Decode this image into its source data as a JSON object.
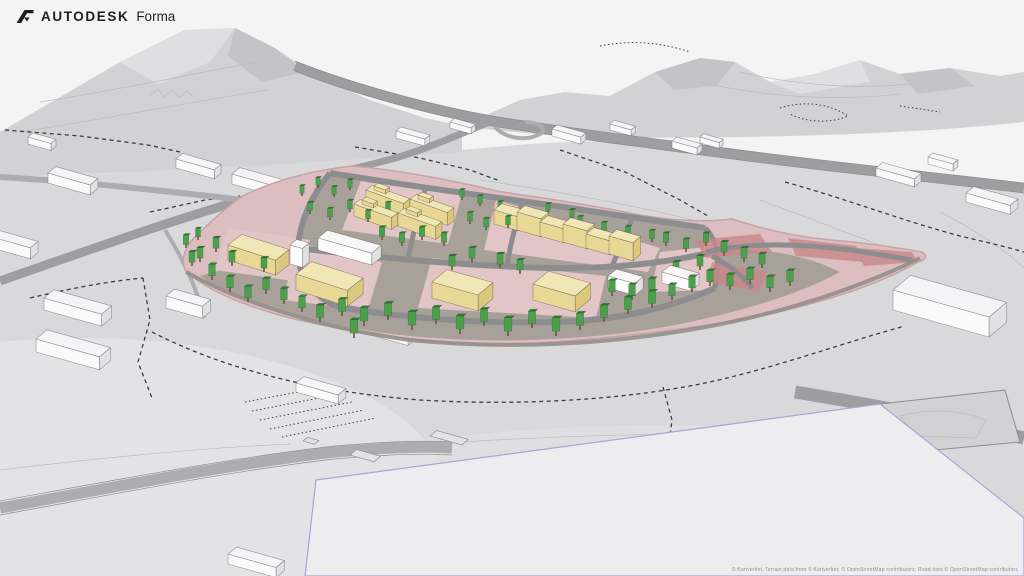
{
  "header": {
    "brand_primary": "AUTODESK",
    "brand_product": "Forma"
  },
  "footer": {
    "attribution": "© Kartverket, Terrain data from © Kartverket, © OpenStreetMap contributors, Road data © OpenStreetMap contributors"
  },
  "colors": {
    "sky": "#f4f4f5",
    "mountain": "#d2d2d5",
    "mountainDark": "#c4c4c8",
    "mountainLight": "#dfdfe1",
    "terrain": "#d9d9db",
    "terrainLight": "#e3e3e5",
    "contour": "#bcbcbf",
    "dash": "#3c3c3c",
    "roadMajor": "#9e9ea0",
    "roadMinor": "#adadaf",
    "roadEdge": "#8c8c8e",
    "sitePink": "#dcbec0",
    "sitePlot": "#e1c5c7",
    "siteEdge": "#c5a3a6",
    "siteGray": "#a8a19a",
    "siteRoad": "#8d8d8f",
    "redRoad": "#c78787",
    "perimeter": "#948e88",
    "planeFill": "#ededef",
    "planeEdge": "#b3a0d4",
    "yellowFront": "#e9d795",
    "yellowSide": "#dcc77f",
    "yellowRoof": "#f1e7b6",
    "whiteFront": "#fcfcfd",
    "whiteSide": "#e2e2e5",
    "whiteRoof": "#f7f7f9",
    "ctxFront": "#fafafb",
    "ctxSide": "#e1e1e4",
    "ctxRoof": "#f4f4f6",
    "treeBody": "#4aa04b",
    "treeTop": "#2f7d33",
    "treeTrunk": "#7a5044"
  },
  "scene": {
    "proposal_buildings": [
      {
        "x": 354,
        "y": 216,
        "w": 40,
        "d": 11,
        "h": 12,
        "r": 4,
        "c": "yellow"
      },
      {
        "x": 366,
        "y": 202,
        "w": 40,
        "d": 11,
        "h": 12,
        "r": 4,
        "c": "yellow"
      },
      {
        "x": 398,
        "y": 226,
        "w": 40,
        "d": 11,
        "h": 13,
        "r": 4,
        "c": "yellow"
      },
      {
        "x": 410,
        "y": 212,
        "w": 40,
        "d": 11,
        "h": 13,
        "r": 4,
        "c": "yellow"
      },
      {
        "x": 362,
        "y": 204,
        "w": 12,
        "d": 7,
        "h": 4,
        "r": 4,
        "c": "yellow",
        "z": 217
      },
      {
        "x": 374,
        "y": 190,
        "w": 12,
        "d": 7,
        "h": 4,
        "r": 4,
        "c": "yellow",
        "z": 203
      },
      {
        "x": 406,
        "y": 213,
        "w": 12,
        "d": 7,
        "h": 4,
        "r": 4,
        "c": "yellow",
        "z": 227
      },
      {
        "x": 418,
        "y": 199,
        "w": 12,
        "d": 7,
        "h": 4,
        "r": 4,
        "c": "yellow",
        "z": 213
      },
      {
        "x": 494,
        "y": 224,
        "w": 25,
        "d": 14,
        "h": 14,
        "c": "yellow"
      },
      {
        "x": 517,
        "y": 230,
        "w": 25,
        "d": 14,
        "h": 18,
        "c": "yellow"
      },
      {
        "x": 540,
        "y": 236,
        "w": 25,
        "d": 14,
        "h": 14,
        "c": "yellow"
      },
      {
        "x": 563,
        "y": 242,
        "w": 25,
        "d": 14,
        "h": 18,
        "c": "yellow"
      },
      {
        "x": 586,
        "y": 248,
        "w": 25,
        "d": 14,
        "h": 14,
        "c": "yellow"
      },
      {
        "x": 609,
        "y": 254,
        "w": 25,
        "d": 14,
        "h": 18,
        "c": "yellow"
      },
      {
        "x": 228,
        "y": 260,
        "w": 50,
        "d": 24,
        "h": 15,
        "r": 2,
        "c": "yellow"
      },
      {
        "x": 296,
        "y": 290,
        "w": 54,
        "d": 28,
        "h": 16,
        "r": 2,
        "c": "yellow"
      },
      {
        "x": 432,
        "y": 298,
        "w": 48,
        "d": 27,
        "h": 16,
        "c": "yellow"
      },
      {
        "x": 533,
        "y": 300,
        "w": 44,
        "d": 28,
        "h": 16,
        "c": "yellow"
      },
      {
        "x": 290,
        "y": 264,
        "w": 13,
        "d": 12,
        "h": 19,
        "c": "white"
      },
      {
        "x": 318,
        "y": 250,
        "w": 56,
        "d": 17,
        "h": 12,
        "c": "white"
      },
      {
        "x": 608,
        "y": 288,
        "w": 28,
        "d": 15,
        "h": 12,
        "c": "white"
      },
      {
        "x": 662,
        "y": 283,
        "w": 30,
        "d": 15,
        "h": 11,
        "c": "white"
      }
    ],
    "context_buildings": [
      {
        "x": 28,
        "y": 144,
        "w": 24,
        "d": 9,
        "h": 7
      },
      {
        "x": 48,
        "y": 183,
        "w": 44,
        "d": 14,
        "h": 10
      },
      {
        "x": -8,
        "y": 248,
        "w": 40,
        "d": 14,
        "h": 11
      },
      {
        "x": 44,
        "y": 310,
        "w": 60,
        "d": 18,
        "h": 12
      },
      {
        "x": 36,
        "y": 352,
        "w": 66,
        "d": 20,
        "h": 13
      },
      {
        "x": 166,
        "y": 308,
        "w": 38,
        "d": 15,
        "h": 12
      },
      {
        "x": 176,
        "y": 168,
        "w": 40,
        "d": 12,
        "h": 9
      },
      {
        "x": 232,
        "y": 184,
        "w": 48,
        "d": 14,
        "h": 10
      },
      {
        "x": 360,
        "y": 332,
        "w": 50,
        "d": 18,
        "h": 11
      },
      {
        "x": 296,
        "y": 392,
        "w": 44,
        "d": 14,
        "h": 9
      },
      {
        "x": 396,
        "y": 138,
        "w": 30,
        "d": 9,
        "h": 7
      },
      {
        "x": 450,
        "y": 128,
        "w": 22,
        "d": 8,
        "h": 6
      },
      {
        "x": 552,
        "y": 136,
        "w": 30,
        "d": 9,
        "h": 7
      },
      {
        "x": 610,
        "y": 130,
        "w": 22,
        "d": 8,
        "h": 6
      },
      {
        "x": 672,
        "y": 148,
        "w": 26,
        "d": 9,
        "h": 7
      },
      {
        "x": 700,
        "y": 143,
        "w": 20,
        "d": 7,
        "h": 6
      },
      {
        "x": 876,
        "y": 176,
        "w": 40,
        "d": 12,
        "h": 8
      },
      {
        "x": 928,
        "y": 164,
        "w": 26,
        "d": 9,
        "h": 7
      },
      {
        "x": 966,
        "y": 202,
        "w": 46,
        "d": 14,
        "h": 9
      },
      {
        "x": 893,
        "y": 310,
        "w": 100,
        "d": 32,
        "h": 20
      },
      {
        "x": 228,
        "y": 564,
        "w": 50,
        "d": 15,
        "h": 10
      }
    ],
    "footprints": [
      {
        "x": 303,
        "y": 441,
        "w": 12,
        "d": 8
      },
      {
        "x": 350,
        "y": 455,
        "w": 25,
        "d": 12
      },
      {
        "x": 430,
        "y": 436,
        "w": 33,
        "d": 12
      }
    ],
    "trees": [
      [
        302,
        196,
        8
      ],
      [
        318,
        188,
        8
      ],
      [
        334,
        197,
        8
      ],
      [
        350,
        190,
        8
      ],
      [
        310,
        214,
        9
      ],
      [
        330,
        220,
        9
      ],
      [
        350,
        212,
        9
      ],
      [
        368,
        222,
        9
      ],
      [
        388,
        214,
        9
      ],
      [
        462,
        200,
        8
      ],
      [
        480,
        206,
        8
      ],
      [
        500,
        212,
        8
      ],
      [
        470,
        224,
        9
      ],
      [
        486,
        230,
        9
      ],
      [
        508,
        228,
        9
      ],
      [
        532,
        226,
        9
      ],
      [
        556,
        232,
        9
      ],
      [
        580,
        228,
        9
      ],
      [
        604,
        234,
        9
      ],
      [
        628,
        238,
        9
      ],
      [
        652,
        242,
        9
      ],
      [
        548,
        214,
        8
      ],
      [
        572,
        220,
        8
      ],
      [
        186,
        248,
        10
      ],
      [
        198,
        240,
        9
      ],
      [
        192,
        266,
        11
      ],
      [
        216,
        252,
        11
      ],
      [
        200,
        262,
        11
      ],
      [
        232,
        266,
        11
      ],
      [
        248,
        256,
        11
      ],
      [
        212,
        280,
        12
      ],
      [
        230,
        292,
        12
      ],
      [
        248,
        302,
        12
      ],
      [
        266,
        294,
        12
      ],
      [
        284,
        304,
        12
      ],
      [
        302,
        312,
        12
      ],
      [
        264,
        272,
        11
      ],
      [
        382,
        240,
        10
      ],
      [
        402,
        246,
        10
      ],
      [
        422,
        240,
        10
      ],
      [
        444,
        246,
        10
      ],
      [
        452,
        270,
        11
      ],
      [
        472,
        262,
        11
      ],
      [
        500,
        268,
        11
      ],
      [
        520,
        274,
        11
      ],
      [
        320,
        322,
        13
      ],
      [
        342,
        316,
        13
      ],
      [
        364,
        326,
        14
      ],
      [
        388,
        320,
        13
      ],
      [
        412,
        330,
        14
      ],
      [
        436,
        324,
        13
      ],
      [
        460,
        334,
        14
      ],
      [
        484,
        326,
        13
      ],
      [
        508,
        336,
        14
      ],
      [
        532,
        328,
        13
      ],
      [
        556,
        336,
        14
      ],
      [
        580,
        330,
        13
      ],
      [
        604,
        322,
        13
      ],
      [
        628,
        314,
        13
      ],
      [
        652,
        308,
        13
      ],
      [
        354,
        338,
        14
      ],
      [
        612,
        296,
        12
      ],
      [
        632,
        300,
        12
      ],
      [
        652,
        294,
        12
      ],
      [
        672,
        300,
        12
      ],
      [
        692,
        292,
        12
      ],
      [
        710,
        286,
        12
      ],
      [
        730,
        290,
        12
      ],
      [
        750,
        284,
        12
      ],
      [
        770,
        292,
        12
      ],
      [
        790,
        286,
        12
      ],
      [
        666,
        246,
        10
      ],
      [
        686,
        252,
        10
      ],
      [
        706,
        246,
        10
      ],
      [
        724,
        256,
        11
      ],
      [
        744,
        262,
        11
      ],
      [
        762,
        268,
        11
      ],
      [
        700,
        270,
        11
      ],
      [
        676,
        276,
        11
      ]
    ]
  }
}
